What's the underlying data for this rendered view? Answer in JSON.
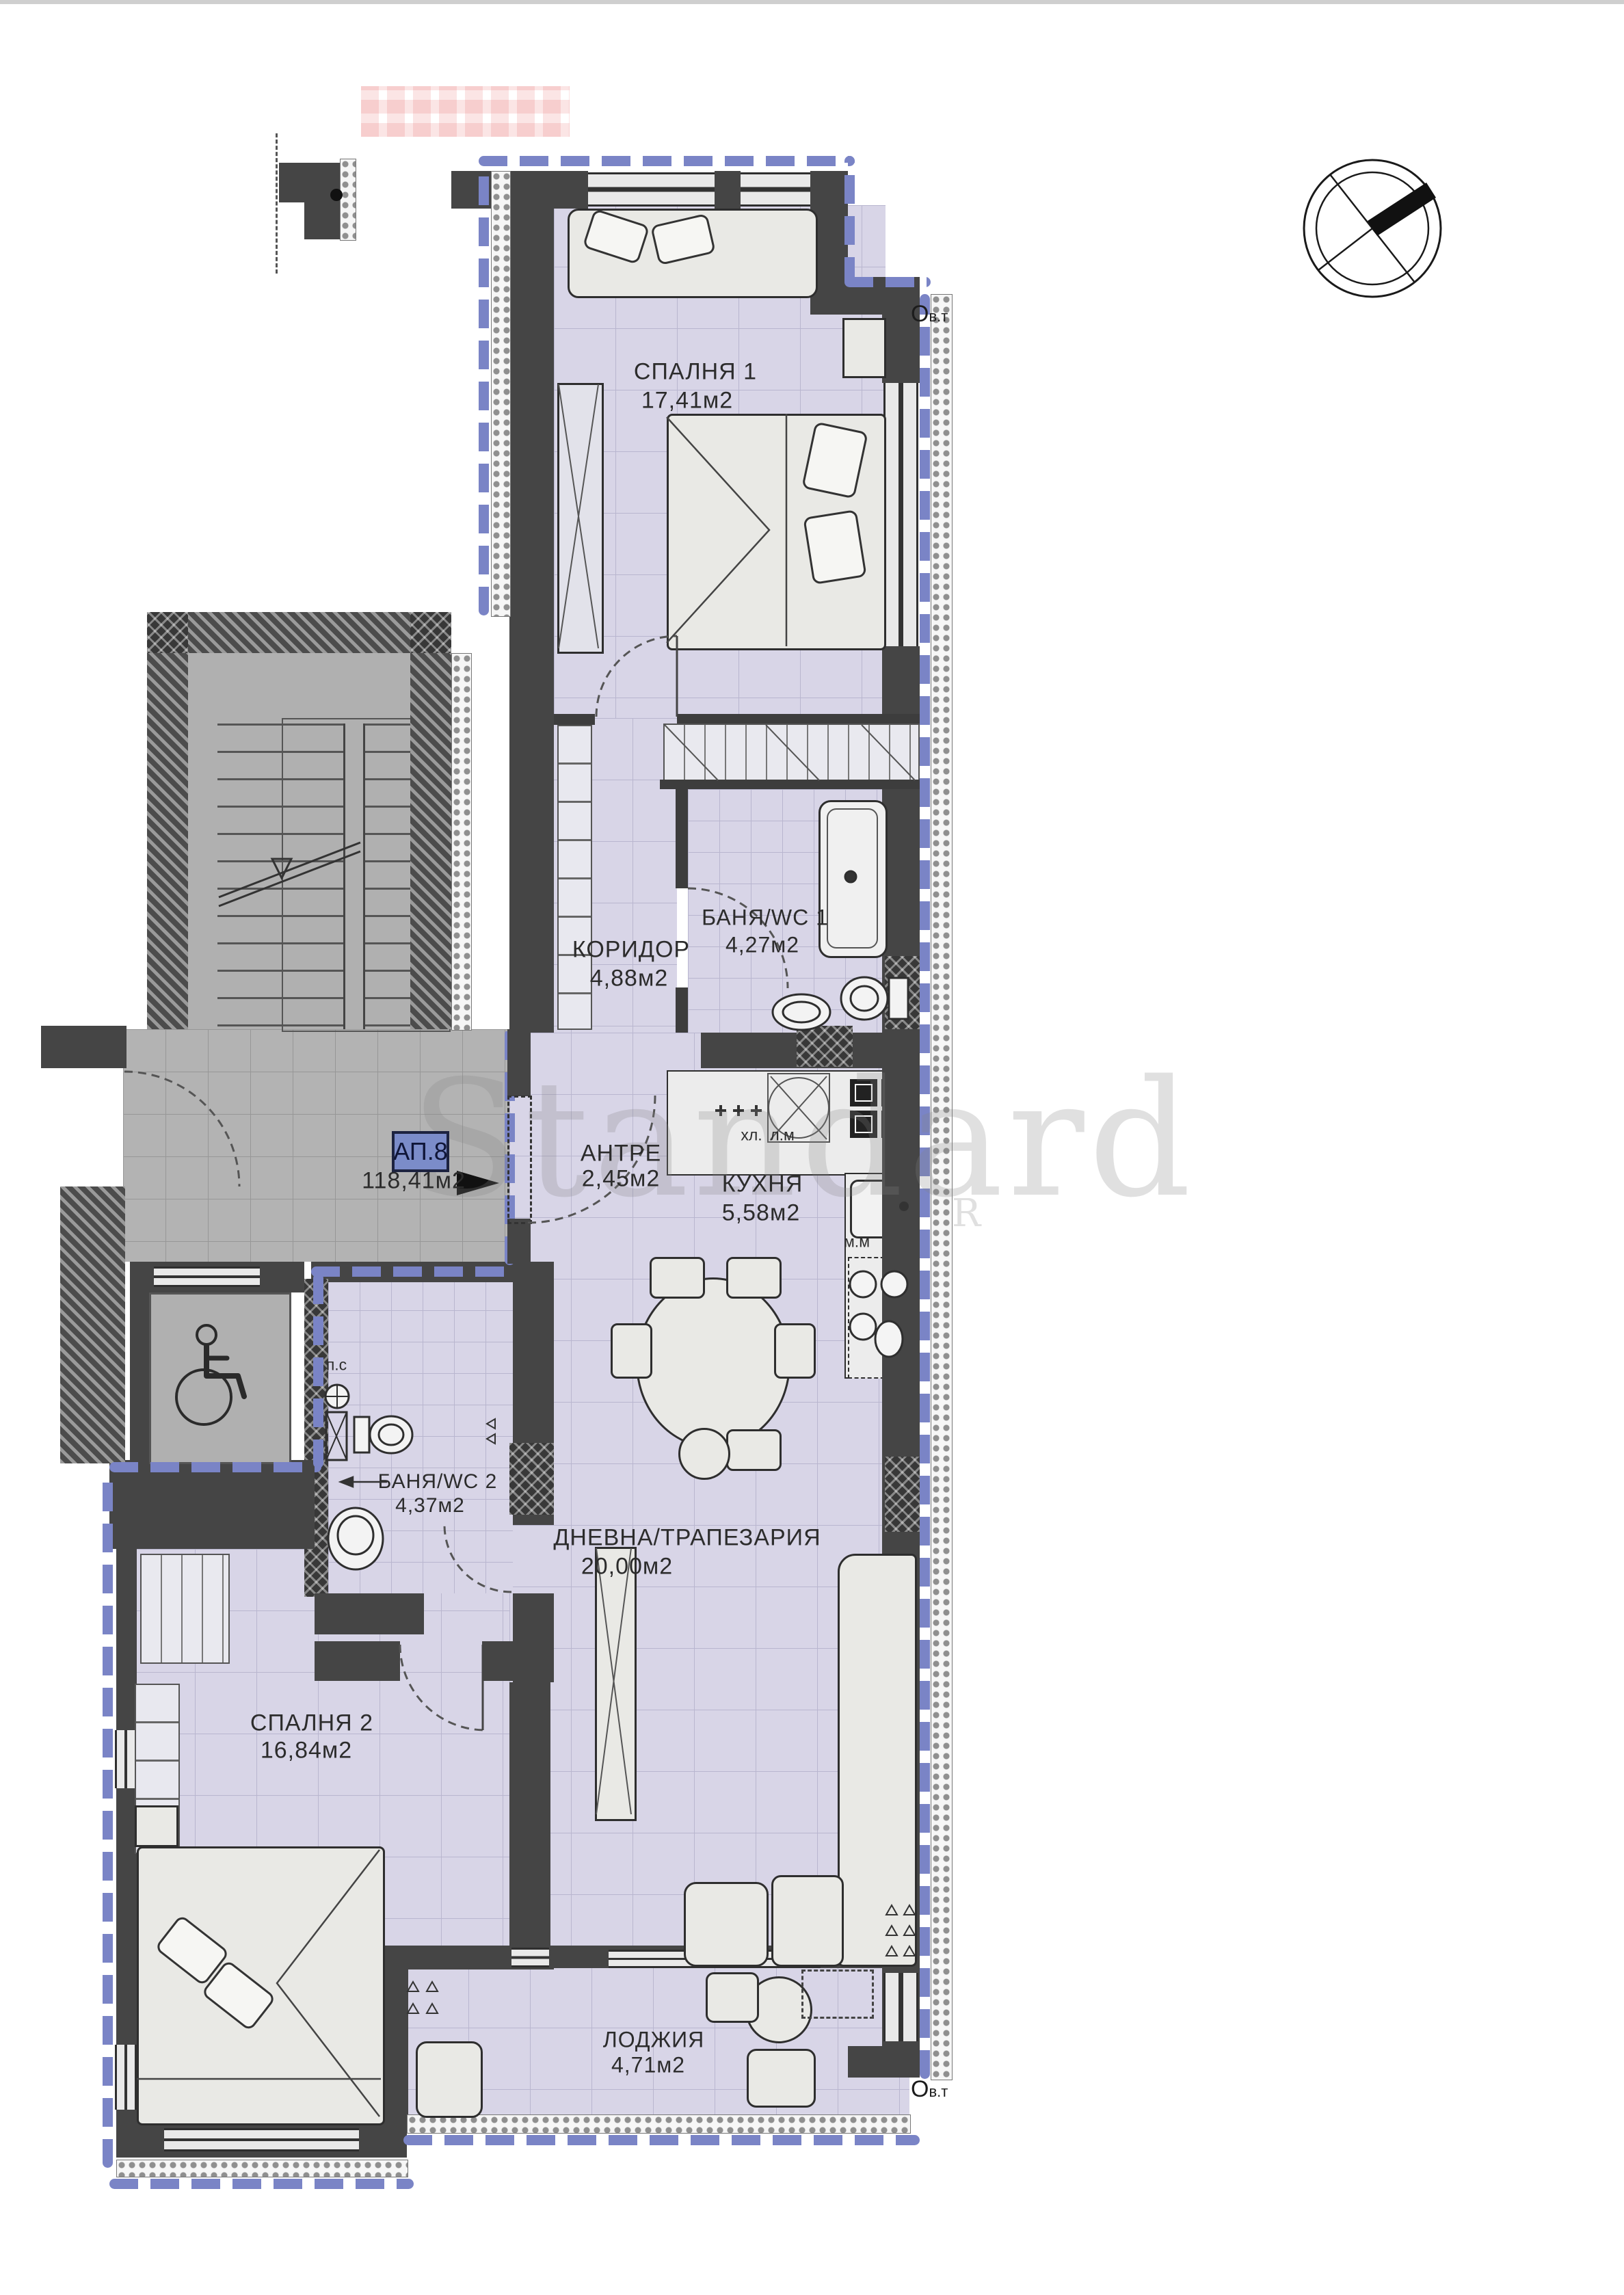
{
  "document": {
    "type": "apartment floor plan",
    "watermark": "Standard",
    "watermark_partial": "R",
    "boundary_color": "#7a84c6",
    "wall_color": "#454545",
    "floor_color": "#d8d5e7"
  },
  "apartment": {
    "badge": {
      "label": "АП.8",
      "area": "118,41м2"
    },
    "rooms": [
      {
        "key": "bedroom1",
        "name": "СПАЛНЯ 1",
        "area": "17,41м2"
      },
      {
        "key": "corridor",
        "name": "КОРИДОР",
        "area": "4,88м2"
      },
      {
        "key": "bath1",
        "name": "БАНЯ/WC 1",
        "area": "4,27м2"
      },
      {
        "key": "antre",
        "name": "АНТРЕ",
        "area": "2,45м2"
      },
      {
        "key": "kitchen",
        "name": "КУХНЯ",
        "area": "5,58м2"
      },
      {
        "key": "living",
        "name": "ДНЕВНА/ТРАПЕЗАРИЯ",
        "area": "20,00м2"
      },
      {
        "key": "bath2",
        "name": "БАНЯ/WC 2",
        "area": "4,37м2"
      },
      {
        "key": "bedroom2",
        "name": "СПАЛНЯ 2",
        "area": "16,84м2"
      },
      {
        "key": "loggia",
        "name": "ЛОДЖИЯ",
        "area": "4,71м2"
      }
    ],
    "annotations": {
      "fridge": "хл.",
      "washer": "л.м",
      "dishwasher": "м.м",
      "ceiling": "п.с",
      "vent_o": "О",
      "vent_sub": "в.т"
    }
  }
}
